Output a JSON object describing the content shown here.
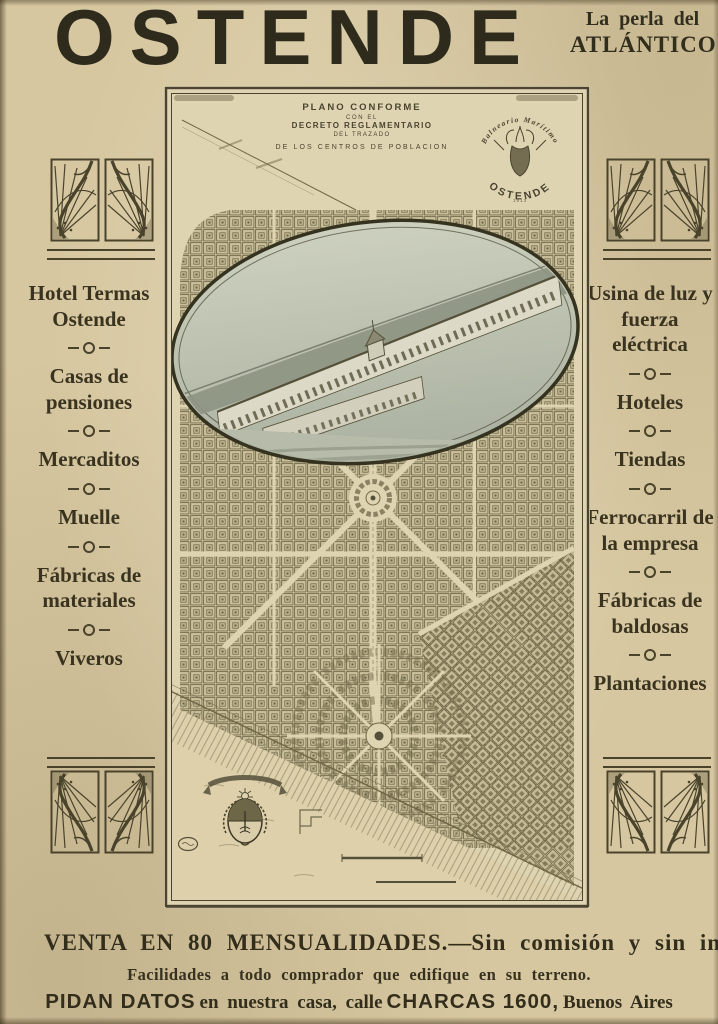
{
  "colors": {
    "paper": "#d6c7a0",
    "ink": "#3a3422",
    "map_paper": "#dfd4b2"
  },
  "header": {
    "title": "OSTENDE",
    "slogan_line1": "La perla del",
    "slogan_line2": "ATLÁNTICO"
  },
  "left_column": {
    "items": [
      "Hotel Termas Ostende",
      "Casas de pensiones",
      "Mercaditos",
      "Muelle",
      "Fábricas de materiales",
      "Viveros"
    ]
  },
  "right_column": {
    "items": [
      "Usina de luz y fuerza eléctrica",
      "Hoteles",
      "Tiendas",
      "Ferrocarril de la empresa",
      "Fábricas de baldosas",
      "Plantaciones"
    ]
  },
  "map": {
    "plan_title": {
      "line1": "PLANO CONFORME",
      "line2": "CON EL",
      "line3": "DECRETO REGLAMENTARIO",
      "line4": "DEL TRAZADO",
      "line5": "DE LOS CENTROS DE POBLACION"
    },
    "crest": {
      "arc_top": "Balneario Marítimo",
      "name": "OSTENDE",
      "year": "1913"
    }
  },
  "footer": {
    "line1_left": "VENTA EN 80 MENSUALIDADES.",
    "line1_dash": "—",
    "line1_right": "Sin comisión y sin intereses",
    "line2": "Facilidades a todo comprador que edifique en su terreno.",
    "line3_part1": "PIDAN DATOS",
    "line3_part2": "en nuestra casa, calle",
    "line3_part3": "CHARCAS 1600,",
    "line3_part4": "Buenos Aires"
  }
}
